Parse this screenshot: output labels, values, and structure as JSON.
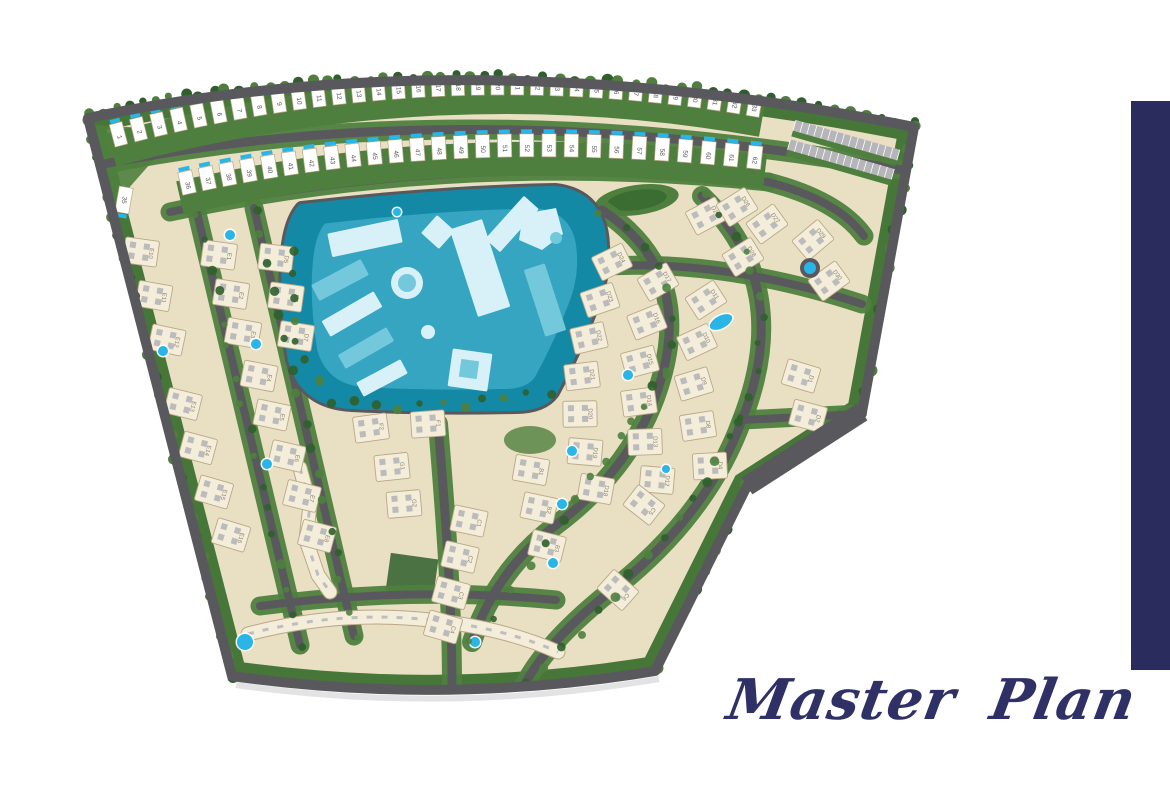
{
  "title": "Master Plan",
  "colors": {
    "page_bg": "#ffffff",
    "accent_navy": "#2b2c5e",
    "title_navy": "#2e3066",
    "road": "#59595d",
    "road_light": "#b5b5ba",
    "green": "#4e7f3e",
    "green_dark": "#2f5f2c",
    "green_light": "#6fa355",
    "sand": "#e9dfc2",
    "path_sand": "#d9cda9",
    "building": "#f4edda",
    "building_border": "#b9a887",
    "roof_gray": "#b2b2b6",
    "lagoon_water": "#1489a6",
    "lagoon_deck": "#39a8c4",
    "lagoon_mid": "#74c8dc",
    "lagoon_building": "#d8f1f8",
    "pool_cyan": "#29b5e6",
    "label_gray": "#8d8472",
    "number_gray": "#55555a",
    "shadow_gray": "#c2c2c4"
  },
  "townhouses": {
    "row1_numbers": [
      "1",
      "2",
      "3",
      "4",
      "5",
      "6",
      "7",
      "8",
      "9",
      "10",
      "11",
      "12",
      "13",
      "14",
      "15",
      "16",
      "17",
      "18",
      "19",
      "20",
      "21",
      "22",
      "23",
      "24",
      "25",
      "26",
      "27",
      "28",
      "29",
      "30",
      "31",
      "32",
      "33"
    ],
    "block_numbers": [
      "34",
      "35"
    ],
    "row2_numbers": [
      "36",
      "37",
      "38",
      "39",
      "40",
      "41",
      "42",
      "43",
      "44",
      "45",
      "46",
      "47",
      "48",
      "49",
      "50",
      "51",
      "52",
      "53",
      "54",
      "55",
      "56",
      "57",
      "58",
      "59",
      "60",
      "61",
      "62"
    ]
  },
  "villas": [
    {
      "label": "E10",
      "x": 141,
      "y": 252,
      "r": 8
    },
    {
      "label": "E11",
      "x": 154,
      "y": 296,
      "r": 10
    },
    {
      "label": "E12",
      "x": 167,
      "y": 340,
      "r": 12
    },
    {
      "label": "E13",
      "x": 183,
      "y": 404,
      "r": 14
    },
    {
      "label": "E14",
      "x": 198,
      "y": 448,
      "r": 15
    },
    {
      "label": "E15",
      "x": 214,
      "y": 492,
      "r": 16
    },
    {
      "label": "E16",
      "x": 231,
      "y": 535,
      "r": 17
    },
    {
      "label": "E1",
      "x": 219,
      "y": 255,
      "r": 8
    },
    {
      "label": "E2",
      "x": 231,
      "y": 294,
      "r": 9
    },
    {
      "label": "E3",
      "x": 243,
      "y": 333,
      "r": 10
    },
    {
      "label": "E4",
      "x": 259,
      "y": 376,
      "r": 11
    },
    {
      "label": "E5",
      "x": 272,
      "y": 415,
      "r": 12
    },
    {
      "label": "E6",
      "x": 287,
      "y": 456,
      "r": 13
    },
    {
      "label": "E7",
      "x": 302,
      "y": 496,
      "r": 14
    },
    {
      "label": "E8",
      "x": 317,
      "y": 536,
      "r": 15
    },
    {
      "label": "D5",
      "x": 276,
      "y": 258,
      "r": 7
    },
    {
      "label": "D6",
      "x": 286,
      "y": 297,
      "r": 8
    },
    {
      "label": "D7",
      "x": 296,
      "y": 336,
      "r": 9
    },
    {
      "label": "F2",
      "x": 371,
      "y": 428,
      "r": -8
    },
    {
      "label": "F1",
      "x": 428,
      "y": 424,
      "r": -4
    },
    {
      "label": "G1",
      "x": 392,
      "y": 467,
      "r": -6
    },
    {
      "label": "G2",
      "x": 404,
      "y": 504,
      "r": -5
    },
    {
      "label": "C1",
      "x": 469,
      "y": 521,
      "r": 12
    },
    {
      "label": "C2",
      "x": 460,
      "y": 557,
      "r": 13
    },
    {
      "label": "C3",
      "x": 451,
      "y": 593,
      "r": 15
    },
    {
      "label": "C4",
      "x": 443,
      "y": 627,
      "r": 16
    },
    {
      "label": "B1",
      "x": 531,
      "y": 470,
      "r": 10
    },
    {
      "label": "B2",
      "x": 539,
      "y": 508,
      "r": 12
    },
    {
      "label": "B3",
      "x": 547,
      "y": 546,
      "r": 14
    },
    {
      "label": "D24",
      "x": 612,
      "y": 262,
      "r": -26
    },
    {
      "label": "D23",
      "x": 600,
      "y": 300,
      "r": -19
    },
    {
      "label": "D22",
      "x": 589,
      "y": 338,
      "r": -13
    },
    {
      "label": "D21",
      "x": 582,
      "y": 376,
      "r": -7
    },
    {
      "label": "D20",
      "x": 580,
      "y": 414,
      "r": -1
    },
    {
      "label": "D19",
      "x": 585,
      "y": 452,
      "r": 5
    },
    {
      "label": "D18",
      "x": 596,
      "y": 489,
      "r": 10
    },
    {
      "label": "D17",
      "x": 658,
      "y": 282,
      "r": -30
    },
    {
      "label": "D16",
      "x": 647,
      "y": 322,
      "r": -22
    },
    {
      "label": "D15",
      "x": 640,
      "y": 362,
      "r": -15
    },
    {
      "label": "D14",
      "x": 639,
      "y": 402,
      "r": -8
    },
    {
      "label": "D13",
      "x": 645,
      "y": 442,
      "r": -2
    },
    {
      "label": "D12",
      "x": 657,
      "y": 480,
      "r": 5
    },
    {
      "label": "D11",
      "x": 706,
      "y": 300,
      "r": -33
    },
    {
      "label": "D10",
      "x": 697,
      "y": 342,
      "r": -25
    },
    {
      "label": "D9",
      "x": 694,
      "y": 384,
      "r": -17
    },
    {
      "label": "D8",
      "x": 698,
      "y": 426,
      "r": -9
    },
    {
      "label": "D4",
      "x": 710,
      "y": 466,
      "r": -3
    },
    {
      "label": "C5",
      "x": 644,
      "y": 505,
      "r": 38
    },
    {
      "label": "C6",
      "x": 618,
      "y": 590,
      "r": 42
    },
    {
      "label": "D1",
      "x": 801,
      "y": 376,
      "r": 17
    },
    {
      "label": "D2",
      "x": 808,
      "y": 416,
      "r": 15
    },
    {
      "label": "D3",
      "x": 815,
      "y": 456,
      "r": 13
    },
    {
      "label": "D25",
      "x": 706,
      "y": 216,
      "r": -28
    },
    {
      "label": "D26",
      "x": 737,
      "y": 207,
      "r": -32
    },
    {
      "label": "D27",
      "x": 767,
      "y": 224,
      "r": -36
    },
    {
      "label": "D28",
      "x": 743,
      "y": 257,
      "r": -32
    },
    {
      "label": "D29",
      "x": 813,
      "y": 240,
      "r": -40
    },
    {
      "label": "D30",
      "x": 829,
      "y": 281,
      "r": -36
    }
  ],
  "pools": [
    {
      "x": 230,
      "y": 235,
      "r": 5
    },
    {
      "x": 163,
      "y": 351,
      "r": 5
    },
    {
      "x": 256,
      "y": 344,
      "r": 5
    },
    {
      "x": 267,
      "y": 464,
      "r": 5
    },
    {
      "x": 245,
      "y": 642,
      "r": 8
    },
    {
      "x": 475,
      "y": 642,
      "r": 5
    },
    {
      "x": 572,
      "y": 451,
      "r": 5
    },
    {
      "x": 562,
      "y": 504,
      "r": 5
    },
    {
      "x": 553,
      "y": 563,
      "r": 5
    },
    {
      "x": 666,
      "y": 469,
      "r": 4
    },
    {
      "x": 628,
      "y": 375,
      "r": 5
    },
    {
      "x": 397,
      "y": 212,
      "r": 4
    }
  ],
  "kidney_pools": [
    {
      "x": 721,
      "y": 322,
      "rx": 13,
      "ry": 7,
      "rot": -28
    }
  ],
  "roundabout": {
    "x": 810,
    "y": 268
  }
}
